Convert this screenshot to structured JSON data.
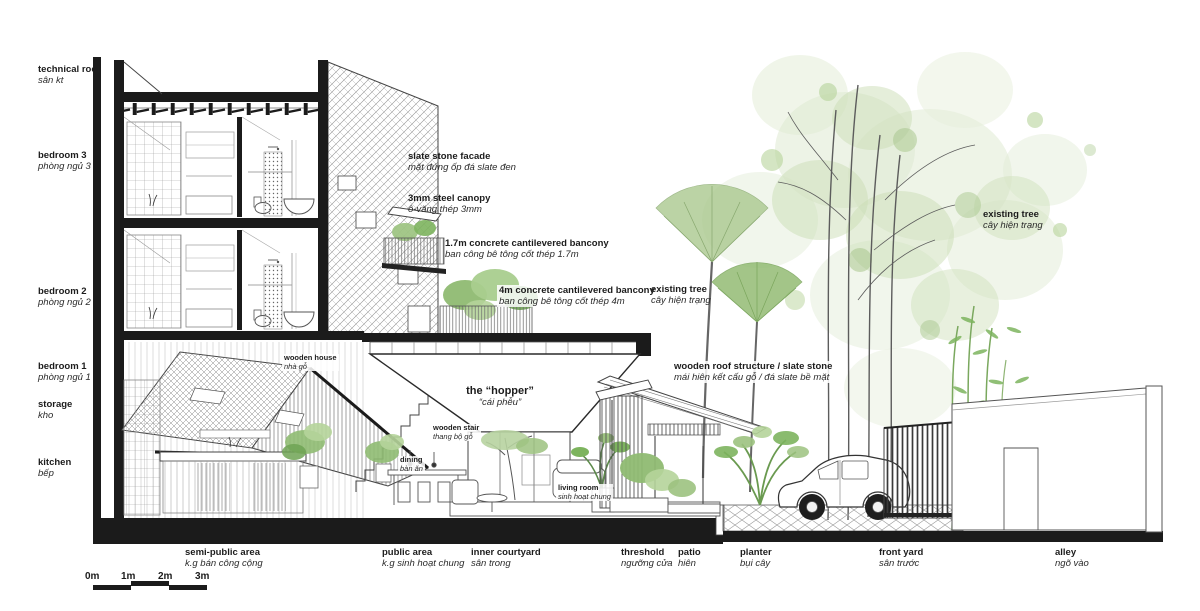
{
  "colors": {
    "line": "#3a3a3a",
    "poche": "#1b1b1b",
    "foliage_light": "#dfead2",
    "foliage_mid": "#b9d3a0",
    "foliage_dark": "#7db45e",
    "ground": "#1b1b1b"
  },
  "labels": {
    "floors": [
      {
        "en": "technical roof",
        "vn": "sân kt"
      },
      {
        "en": "bedroom 3",
        "vn": "phòng ngủ 3"
      },
      {
        "en": "bedroom 2",
        "vn": "phòng ngủ 2"
      },
      {
        "en": "bedroom 1",
        "vn": "phòng ngủ 1"
      },
      {
        "en": "storage",
        "vn": "kho"
      },
      {
        "en": "kitchen",
        "vn": "bếp"
      }
    ],
    "callouts": [
      {
        "en": "slate stone facade",
        "vn": "mặt đứng ốp đá slate đen"
      },
      {
        "en": "3mm steel canopy",
        "vn": "ô-văng thép 3mm"
      },
      {
        "en": "1.7m concrete cantilevered bancony",
        "vn": "ban công bê tông cốt thép 1.7m"
      },
      {
        "en": "4m concrete cantilevered bancony",
        "vn": "ban công bê tông cốt thép 4m"
      },
      {
        "en": "existing tree",
        "vn": "cây hiện trạng"
      },
      {
        "en": "existing tree",
        "vn": "cây hiện trạng"
      },
      {
        "en": "wooden roof structure / slate stone",
        "vn": "mái hiên kết cấu gỗ / đá slate bề mặt"
      },
      {
        "en": "the “hopper”",
        "vn": "“cái phễu”"
      },
      {
        "en": "wooden house",
        "vn": "nhà gỗ"
      },
      {
        "en": "wooden stair",
        "vn": "thang bộ gỗ"
      },
      {
        "en": "dining",
        "vn": "bàn ăn"
      },
      {
        "en": "living room",
        "vn": "sinh hoạt chung"
      }
    ],
    "zones": [
      {
        "en": "semi-public area",
        "vn": "k.g bán công cộng"
      },
      {
        "en": "public area",
        "vn": "k.g sinh hoạt chung"
      },
      {
        "en": "inner courtyard",
        "vn": "sân trong"
      },
      {
        "en": "threshold",
        "vn": "ngưỡng cửa"
      },
      {
        "en": "patio",
        "vn": "hiên"
      },
      {
        "en": "planter",
        "vn": "bụi cây"
      },
      {
        "en": "front yard",
        "vn": "sân trước"
      },
      {
        "en": "alley",
        "vn": "ngõ vào"
      }
    ]
  },
  "scale_bar": {
    "ticks": [
      "0m",
      "1m",
      "2m",
      "3m"
    ]
  }
}
